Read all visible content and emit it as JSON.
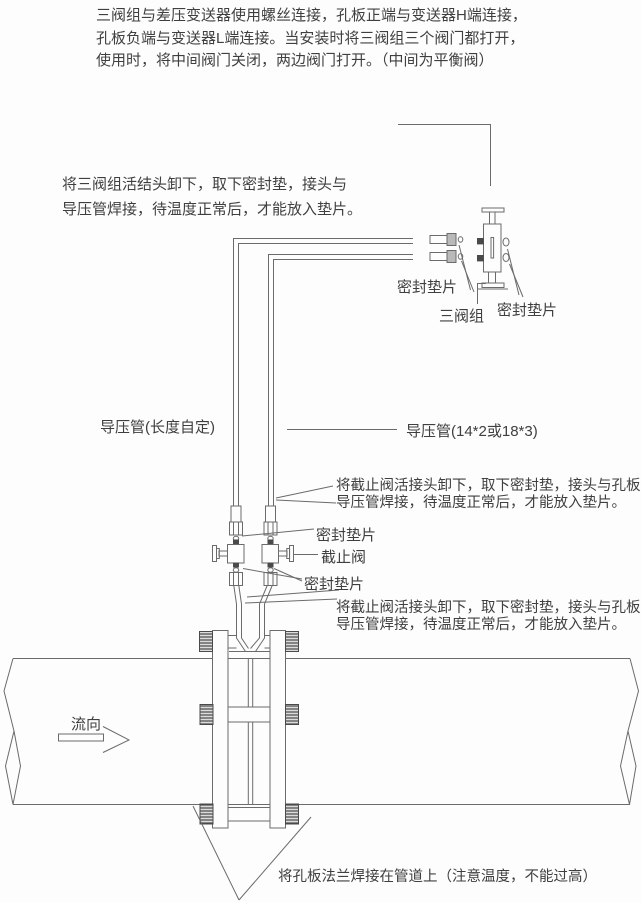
{
  "colors": {
    "background": "#fdfdfd",
    "ink": "#3f3f3f",
    "line": "#6b6b6b",
    "dark_fill": "#4a4a4a"
  },
  "top_note": {
    "line1": "三阀组与差压变送器使用螺丝连接，孔板正端与变送器H端连接，",
    "line2": "孔板负端与变送器L端连接。当安装时将三阀组三个阀门都打开，",
    "line3": "使用时，将中间阀门关闭，两边阀门打开。（中间为平衡阀）"
  },
  "manifold_note": {
    "line1": "将三阀组活结头卸下，取下密封垫，接头与",
    "line2": "导压管焊接，待温度正常后，才能放入垫片。"
  },
  "stop_valve_note_upper": {
    "line1": "将截止阀活接头卸下，取下密封垫，接头与孔板",
    "line2": "导压管焊接，待温度正常后，才能放入垫片。"
  },
  "stop_valve_note_lower": {
    "line1": "将截止阀活接头卸下，取下密封垫，接头与孔板",
    "line2": "导压管焊接，待温度正常后，才能放入垫片。"
  },
  "labels": {
    "seal_gasket_left": "密封垫片",
    "three_valve_manifold": "三阀组",
    "seal_gasket_right": "密封垫片",
    "impulse_pipe_left": "导压管(长度自定)",
    "impulse_pipe_right": "导压管(14*2或18*3)",
    "seal_gasket_valve_top": "密封垫片",
    "stop_valve": "截止阀",
    "seal_gasket_valve_bottom": "密封垫片",
    "flow_direction": "流向",
    "weld_note": "将孔板法兰焊接在管道上（注意温度，不能过高）"
  }
}
